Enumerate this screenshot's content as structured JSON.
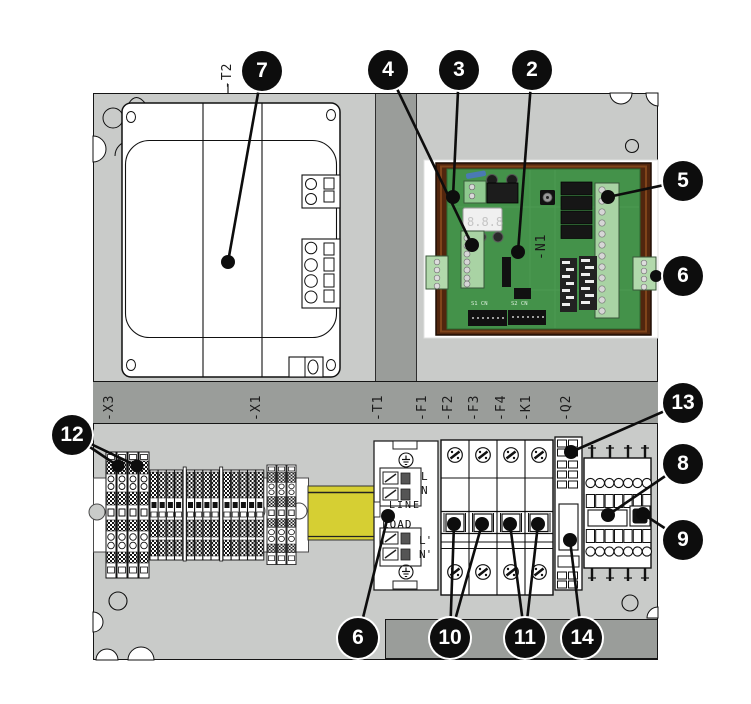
{
  "figure": {
    "type": "control-panel-layout-diagram",
    "colors": {
      "background": "#ffffff",
      "panel_gray": "#c9cbc9",
      "band_gray": "#9a9d9a",
      "din_rail_yellow": "#d6cf33",
      "pcb_green": "#44924a",
      "pcb_frame_brown": "#51260e",
      "balloon_black": "#0d0d0d"
    }
  },
  "labels": {
    "t2": "-T2",
    "n1": "-N1",
    "x3": "-X3",
    "x1": "-X1",
    "t1": "-T1",
    "f1": "-F1",
    "f2": "-F2",
    "f3": "-F3",
    "f4": "-F4",
    "k1": "-K1",
    "q2": "-Q2"
  },
  "filter": {
    "l_in": "L",
    "n_in": "N",
    "line": "LINE",
    "load": "LOAD",
    "l_out": "L'",
    "n_out": "N'"
  },
  "pcb": {
    "display_digits": "8.8.8",
    "silk_row1": "S1  CN",
    "silk_row2": "S2  CN"
  },
  "callouts": [
    {
      "num": "2"
    },
    {
      "num": "3"
    },
    {
      "num": "4"
    },
    {
      "num": "5"
    },
    {
      "num": "6"
    },
    {
      "num": "6"
    },
    {
      "num": "7"
    },
    {
      "num": "8"
    },
    {
      "num": "9"
    },
    {
      "num": "10"
    },
    {
      "num": "11"
    },
    {
      "num": "12"
    },
    {
      "num": "13"
    },
    {
      "num": "14"
    }
  ]
}
